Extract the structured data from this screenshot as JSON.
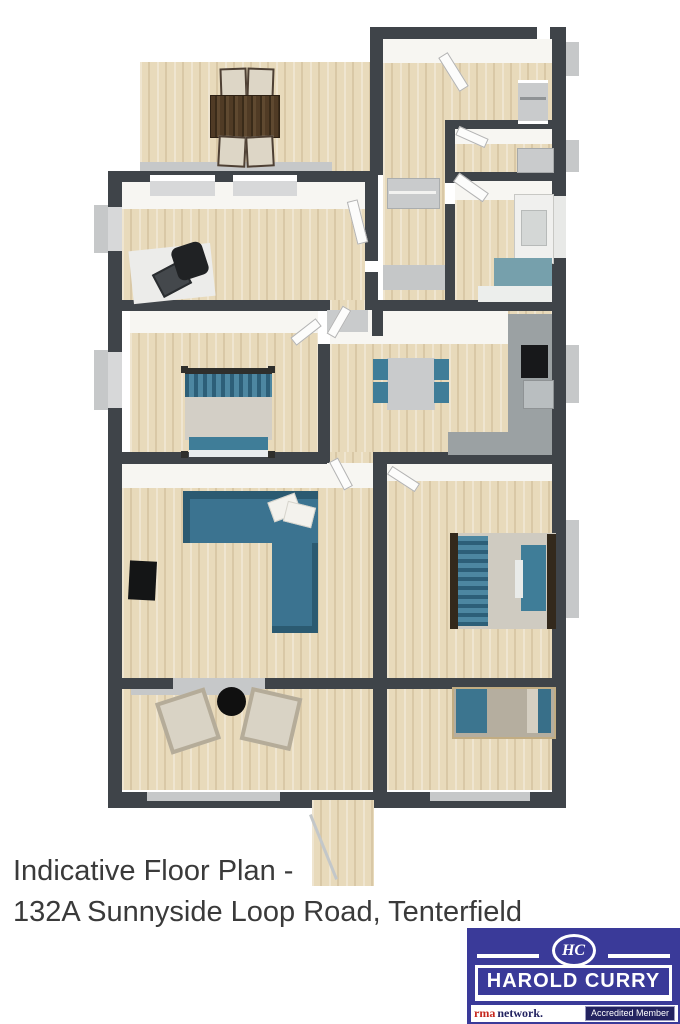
{
  "caption": {
    "line1": "Indicative Floor Plan -",
    "line2": "132A Sunnyside Loop Road, Tenterfield"
  },
  "logo": {
    "monogram": "HC",
    "name": "HAROLD CURRY",
    "rma": "rma",
    "network": "network.",
    "badge": "Accredited Member"
  },
  "colors": {
    "wall": "#3f4449",
    "wood": "#e8dabb",
    "face": "#f7f6f2",
    "sill": "#c6c8c9",
    "counter": "#9ba1a3",
    "teal": "#3f7d98",
    "tealDark": "#2b5a71",
    "mattress": "#d3cfc6",
    "brown": "#4c3827",
    "black": "#17181a",
    "logoBlue": "#3a3a99",
    "logoRed": "#c5271d",
    "logoNavy": "#232360"
  }
}
